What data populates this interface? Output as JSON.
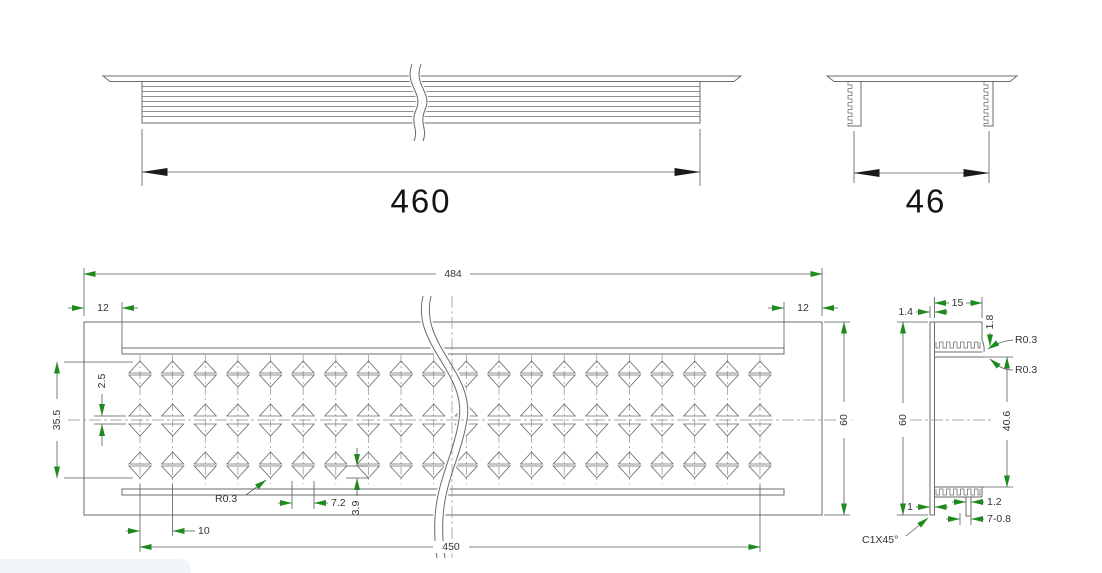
{
  "drawing_type": "technical-drawing",
  "labels": {
    "side": {
      "length": "460"
    },
    "end": {
      "width": "46"
    },
    "plan": {
      "overall": "484",
      "inset_left": "12",
      "inset_right": "12",
      "width": "60",
      "field_height": "35.5",
      "center_gap": "2.5",
      "fillet": "R0.3",
      "hole_width": "7.2",
      "hole_height": "3.9",
      "pitch": "10",
      "field_length": "450"
    },
    "section": {
      "top_wall": "1.4",
      "leg_length": "15",
      "leg_thickness": "1.8",
      "fillet_top": "R0.3",
      "fillet_bottom": "R0.3",
      "height": "60",
      "inner_height": "40.6",
      "bottom_wall": "1",
      "rib_width": "1.2",
      "chamfer": "C1X45°",
      "rib_spec": "7-0.8"
    }
  },
  "colors": {
    "line": "#6b6b6b",
    "dim": "#5a5a5a",
    "arrow_accent": "#1e8a1e",
    "arrow_big": "#1a1a1a",
    "text": "#333333",
    "big_text": "#141414",
    "corner_chip": "#f1f5f9"
  },
  "geometry": {
    "pattern": {
      "columns": 20,
      "start_x": 140,
      "pitch": 32.63,
      "tri_half_w": 11,
      "tri_h": 12,
      "axis_top": 355,
      "axis_bottom": 484,
      "rows": [
        {
          "dir": "up",
          "top": 361
        },
        {
          "dir": "down",
          "top": 375
        },
        {
          "dir": "up",
          "top": 404
        },
        {
          "dir": "down",
          "top": 424
        },
        {
          "dir": "up",
          "top": 452
        },
        {
          "dir": "down",
          "top": 466
        }
      ]
    }
  }
}
